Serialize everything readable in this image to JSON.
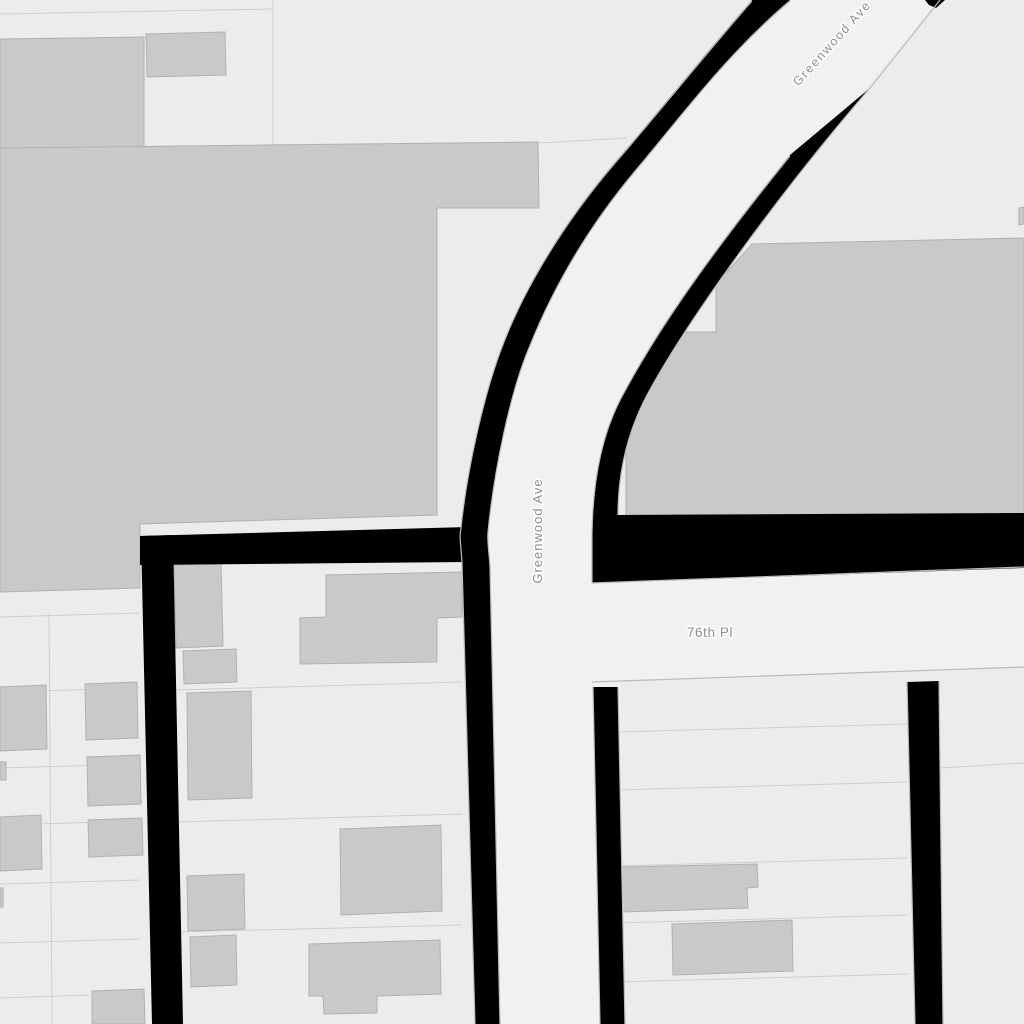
{
  "map": {
    "street_labels": [
      {
        "id": "greenwood-ave-diagonal",
        "text": "Greenwood Ave",
        "orientation": "diagonal"
      },
      {
        "id": "greenwood-ave-vertical",
        "text": "Greenwood Ave",
        "orientation": "vertical"
      },
      {
        "id": "seventy-sixth-pl",
        "text": "76th Pl",
        "orientation": "horizontal"
      }
    ],
    "colors": {
      "background": "#ececec",
      "road_fill": "#f1f1f1",
      "road_casing": "#000000",
      "building_fill": "#c9c9c9",
      "building_stroke": "#b1b1b1",
      "parcel_line": "#cfcfcf",
      "road_edge_line": "#bbbbbb",
      "label_color": "#8d8d8d",
      "label_halo": "#ffffff"
    }
  }
}
